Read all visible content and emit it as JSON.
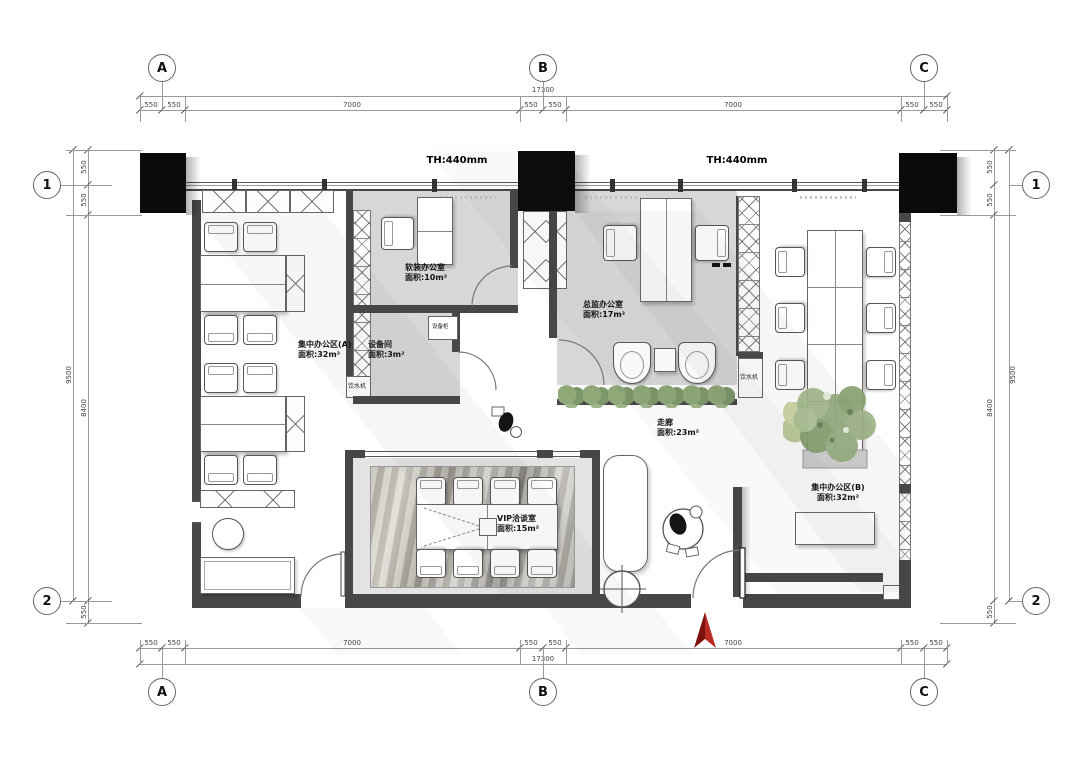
{
  "grid": {
    "top": [
      "A",
      "B",
      "C"
    ],
    "bottom": [
      "A",
      "B",
      "C"
    ],
    "left": [
      "1",
      "2"
    ],
    "right": [
      "1",
      "2"
    ]
  },
  "dims": {
    "top": {
      "total": "17300",
      "segments": [
        "550",
        "550",
        "7000",
        "550",
        "550",
        "7000",
        "550",
        "550"
      ]
    },
    "bottom": {
      "total": "17300",
      "segments": [
        "550",
        "550",
        "7000",
        "550",
        "550",
        "7000",
        "550",
        "550"
      ]
    },
    "left": {
      "total": "9500",
      "segments": [
        "550",
        "550",
        "8400",
        "550"
      ]
    },
    "right": {
      "total": "9500",
      "segments": [
        "550",
        "550",
        "8400",
        "550"
      ]
    }
  },
  "labels": {
    "th_b": "TH:440mm",
    "th_c": "TH:440mm",
    "water_left": "饮水机",
    "water_right": "饮水机",
    "equip_cabinet": "设备柜"
  },
  "rooms": {
    "office_a": {
      "name": "集中办公区(A)",
      "area": "面积:32m²"
    },
    "soft_office": {
      "name": "软装办公室",
      "area": "面积:10m²"
    },
    "equip_room": {
      "name": "设备间",
      "area": "面积:3m²"
    },
    "director": {
      "name": "总监办公室",
      "area": "面积:17m²"
    },
    "corridor": {
      "name": "走廊",
      "area": "面积:23m²"
    },
    "vip": {
      "name": "VIP洽谈室",
      "area": "面积:15m²"
    },
    "office_b": {
      "name": "集中办公区(B)",
      "area": "面积:32m²"
    }
  },
  "colors": {
    "wall": "#474747",
    "column": "#0b0b0b",
    "room_fill": "#d7d7d7",
    "plant": "#8ea877",
    "north_arrow": "#b92a22",
    "dim_line": "#9a9a9a"
  }
}
